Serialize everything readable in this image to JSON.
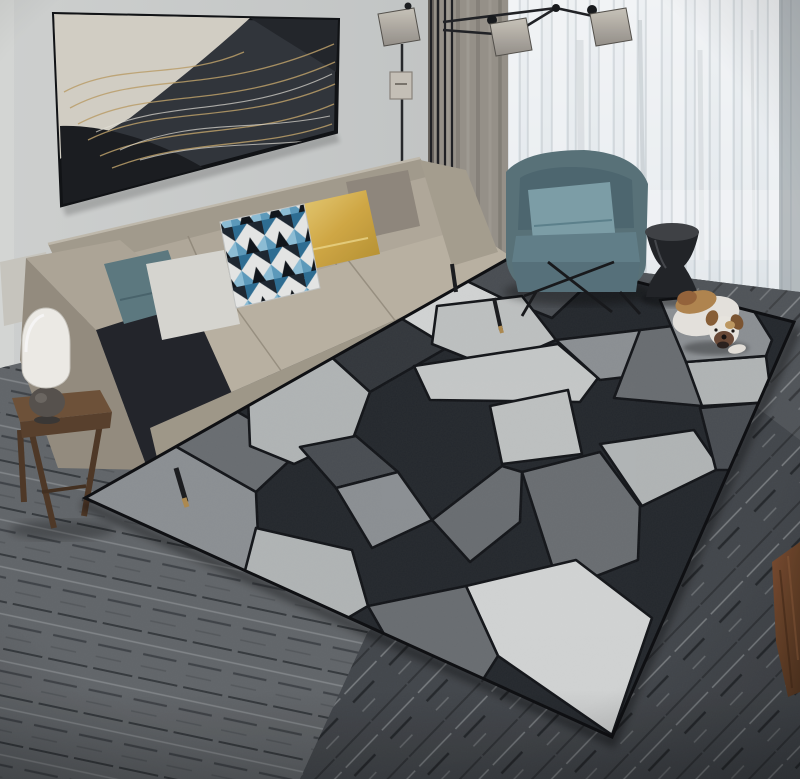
{
  "scene": {
    "kind": "interior-photograph",
    "objects": [
      "abstract-wall-art",
      "beige-sofa",
      "throw-pillows",
      "geometric-area-rug",
      "teal-armchair",
      "black-drum-side-table",
      "bulldog-puppy",
      "wood-side-stool",
      "white-table-lamp",
      "black-multi-arm-floor-lamp",
      "sheer-window-curtains",
      "gray-curtain-panel",
      "gray-wood-plank-floor"
    ]
  },
  "colors": {
    "wall": "#c7cac9",
    "wall_light": "#d6d8d6",
    "floor_base": "#63676a",
    "floor_dark": "#43474b",
    "curtain_taupe": "#98938a",
    "sheer_white": "#ffffff",
    "window_light": "#eef2f4",
    "sofa_beige": "#bcb4a4",
    "sofa_back": "#a59d8e",
    "sofa_shadow": "#968e7f",
    "pillow_teal": "#5d7a81",
    "pillow_white": "#dad9d3",
    "pillow_gold": "#c9a13b",
    "pillow_gray": "#91897d",
    "armchair_teal": "#597379",
    "armchair_pillow": "#7ea0a9",
    "metal_black": "#222427",
    "stool_wood": "#6f5238",
    "lamp_white": "#f1efe9",
    "dog_white": "#e9e6df",
    "dog_tan": "#b3874f",
    "crate_brown": "#7d4e31",
    "art_dark": "#31353a",
    "art_gold": "#bfa26a"
  },
  "rug": {
    "outline": "85,498 520,252 794,322 612,737",
    "base": "#24282c",
    "gap": "#121417",
    "palette": {
      "W": "#d6d8d7",
      "X": "#c9cccb",
      "L": "#b4b8b8",
      "K": "#c2c5c4",
      "M": "#8e9295",
      "G": "#6b6f72",
      "D": "#4a4e52",
      "C": "#33373b"
    },
    "pieces": [
      {
        "f": "M",
        "p": "85,498 168,442 256,492 260,580 198,574 114,542"
      },
      {
        "f": "G",
        "p": "168,442 224,404 302,449 256,492"
      },
      {
        "f": "L",
        "p": "248,398 326,352 370,392 354,436 294,464 250,446"
      },
      {
        "f": "C",
        "p": "326,352 384,308 450,346 370,392"
      },
      {
        "f": "W",
        "p": "384,308 436,266 502,298 450,348"
      },
      {
        "f": "D",
        "p": "436,266 520,252 586,286 552,318 502,298"
      },
      {
        "f": "K",
        "p": "437,306 522,296 556,340 492,368 432,344"
      },
      {
        "f": "X",
        "p": "414,366 558,344 598,378 580,402 430,400"
      },
      {
        "f": "K",
        "p": "490,406 568,390 582,454 502,464"
      },
      {
        "f": "M",
        "p": "556,340 640,330 668,372 600,380"
      },
      {
        "f": "G",
        "p": "640,330 722,320 702,406 614,398"
      },
      {
        "f": "L",
        "p": "686,362 766,356 772,402 702,406"
      },
      {
        "f": "M",
        "p": "660,300 742,292 772,340 766,356 686,362"
      },
      {
        "f": "L",
        "p": "600,444 694,430 720,468 642,506"
      },
      {
        "f": "D",
        "p": "700,408 770,402 744,470 716,470"
      },
      {
        "f": "G",
        "p": "522,472 600,452 640,506 638,560 560,590"
      },
      {
        "f": "W",
        "p": "466,586 576,560 652,618 612,735 498,656"
      },
      {
        "f": "L",
        "p": "256,528 352,550 368,606 300,646 240,590"
      },
      {
        "f": "G",
        "p": "368,606 466,586 498,656 470,700 408,676"
      },
      {
        "f": "D",
        "p": "300,447 356,436 398,472 336,488"
      },
      {
        "f": "M",
        "p": "336,488 398,472 432,520 372,548"
      },
      {
        "f": "G",
        "p": "432,520 502,466 522,472 520,522 470,562"
      }
    ]
  },
  "curtains": {
    "sheer_folds": [
      [
        508,
        10,
        0.5
      ],
      [
        520,
        6,
        0.22
      ],
      [
        528,
        12,
        0.45
      ],
      [
        542,
        8,
        0.18
      ],
      [
        552,
        14,
        0.5
      ],
      [
        568,
        6,
        0.26
      ],
      [
        576,
        12,
        0.46
      ],
      [
        590,
        7,
        0.2
      ],
      [
        599,
        13,
        0.48
      ],
      [
        614,
        8,
        0.26
      ],
      [
        624,
        12,
        0.52
      ],
      [
        638,
        6,
        0.22
      ],
      [
        646,
        14,
        0.46
      ],
      [
        662,
        8,
        0.25
      ],
      [
        672,
        12,
        0.52
      ],
      [
        686,
        7,
        0.22
      ],
      [
        695,
        13,
        0.46
      ],
      [
        710,
        8,
        0.27
      ],
      [
        720,
        12,
        0.52
      ],
      [
        734,
        6,
        0.22
      ],
      [
        742,
        14,
        0.46
      ],
      [
        758,
        8,
        0.27
      ],
      [
        768,
        12,
        0.5
      ],
      [
        782,
        8,
        0.32
      ],
      [
        791,
        9,
        0.45
      ]
    ],
    "fold_height": 318
  }
}
